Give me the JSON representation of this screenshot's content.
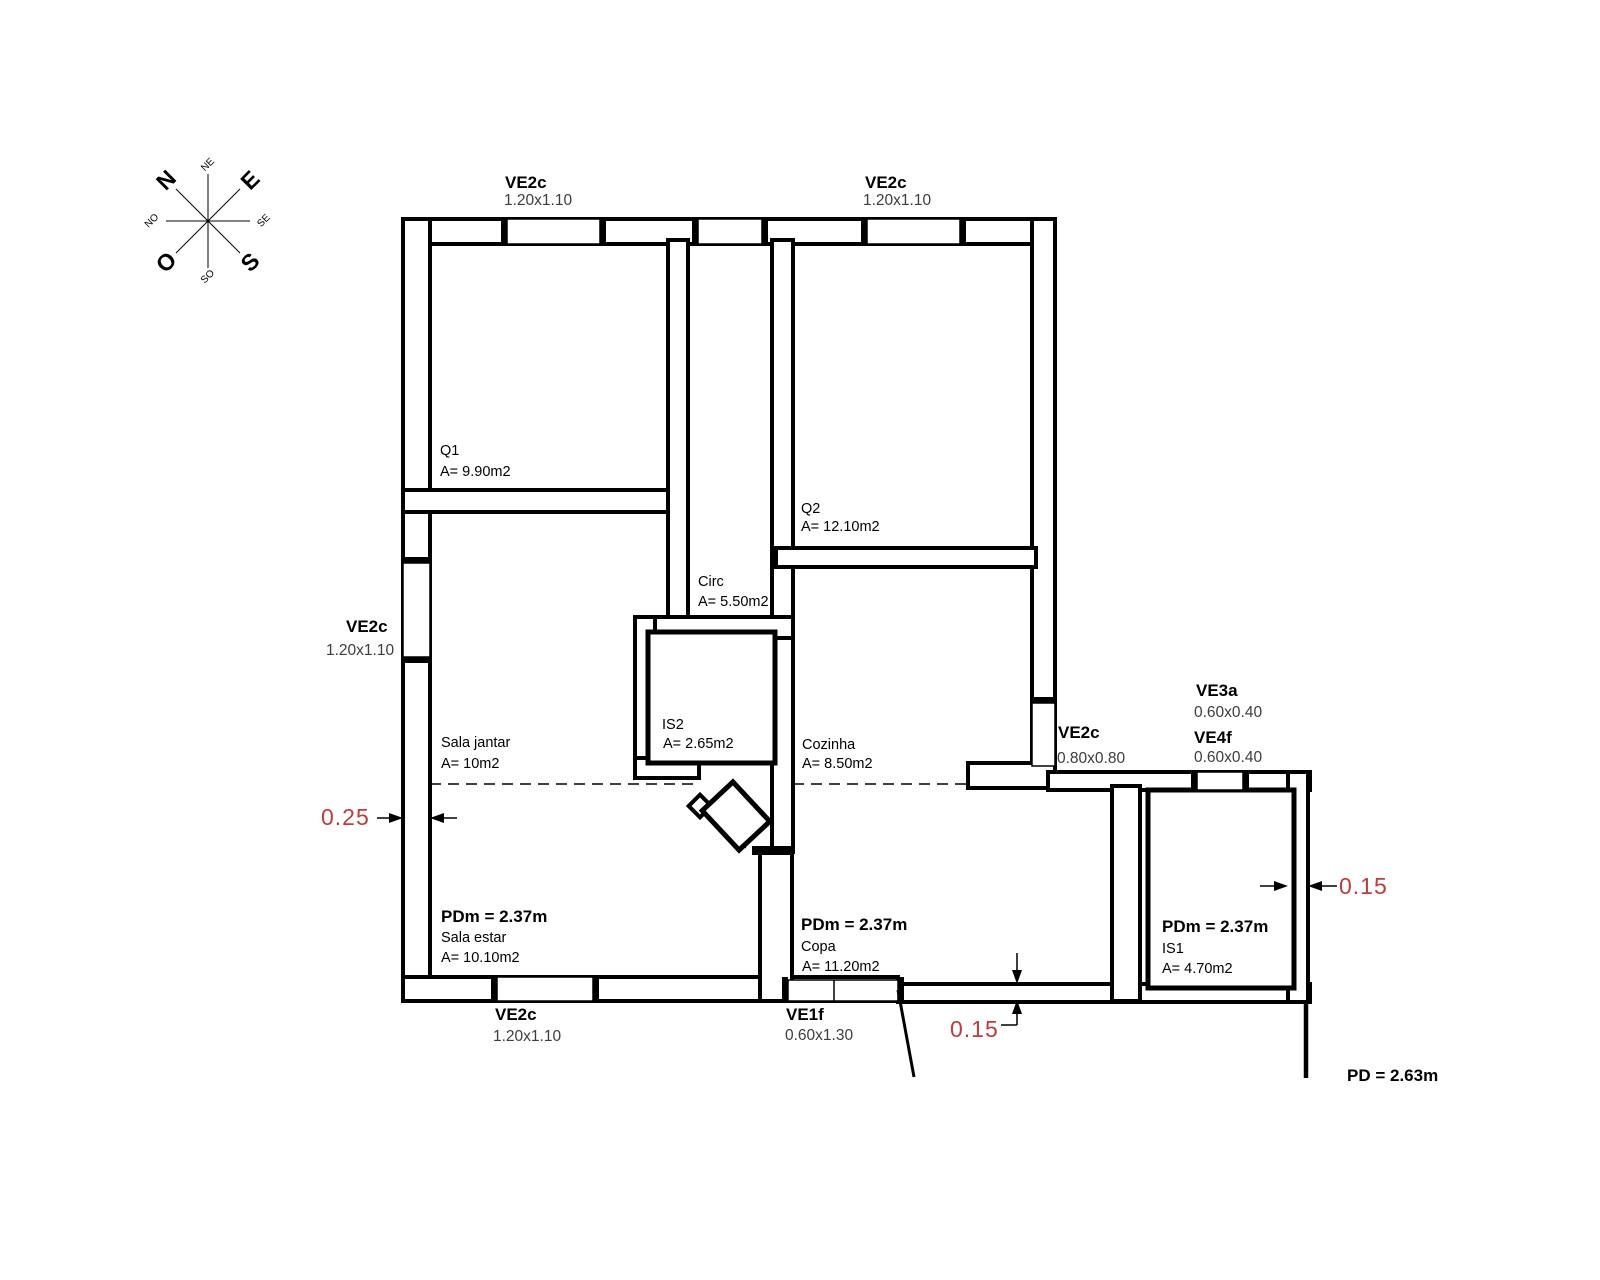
{
  "title": "Floor plan drawing",
  "compass": {
    "n": "N",
    "ne": "NE",
    "e": "E",
    "se": "SE",
    "s": "S",
    "so": "SO",
    "o": "O",
    "no": "NO"
  },
  "rooms": [
    {
      "name": "Q1",
      "area": "A= 9.90m2"
    },
    {
      "name": "Q2",
      "area": "A= 12.10m2"
    },
    {
      "name": "Circ",
      "area": "A= 5.50m2"
    },
    {
      "name": "IS2",
      "area": "A= 2.65m2"
    },
    {
      "name": "Cozinha",
      "area": "A= 8.50m2"
    },
    {
      "name": "Sala jantar",
      "area": "A= 10m2"
    },
    {
      "name": "Sala estar",
      "area": "A= 10.10m2",
      "ceiling": "PDm = 2.37m"
    },
    {
      "name": "Copa",
      "area": "A= 11.20m2",
      "ceiling": "PDm = 2.37m"
    },
    {
      "name": "IS1",
      "area": "A= 4.70m2",
      "ceiling": "PDm = 2.37m"
    }
  ],
  "windows": [
    {
      "code": "VE2c",
      "size": "1.20x1.10"
    },
    {
      "code": "VE2c",
      "size": "1.20x1.10"
    },
    {
      "code": "VE2c",
      "size": "1.20x1.10"
    },
    {
      "code": "VE2c",
      "size": "1.20x1.10"
    },
    {
      "code": "VE1f",
      "size": "0.60x1.30"
    },
    {
      "code": "VE2c",
      "size": "0.80x0.80"
    },
    {
      "code": "VE3a",
      "size": "0.60x0.40"
    },
    {
      "code": "VE4f",
      "size": "0.60x0.40"
    }
  ],
  "dimensions": {
    "left_wall_thickness": "0.25",
    "right_wall_thickness": "0.15",
    "bottom_wall_thickness": "0.15"
  },
  "notes": {
    "ceiling_height": "PD = 2.63m"
  },
  "colors": {
    "dimension_text": "#bf3c3c",
    "line": "#000000"
  }
}
